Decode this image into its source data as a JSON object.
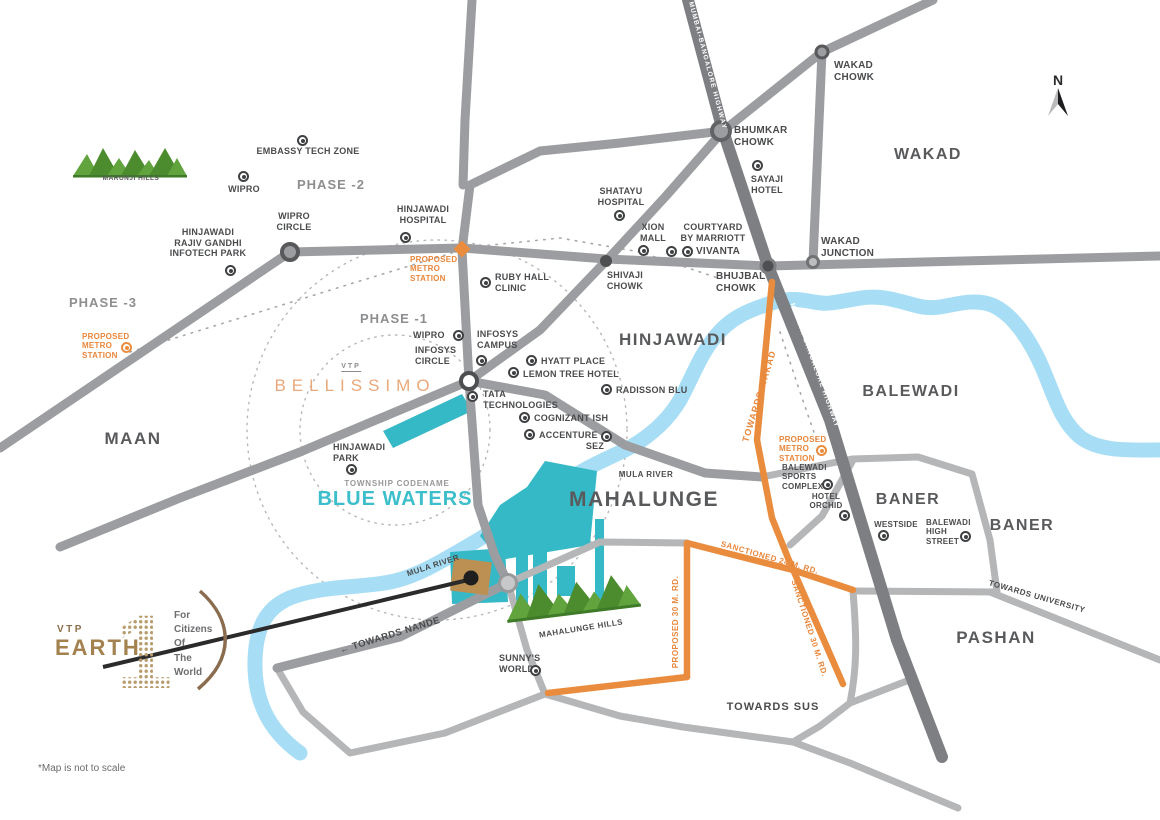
{
  "disclaimer": "*Map is not to scale",
  "compass_label": "N",
  "logo": {
    "brand": "VTP",
    "name": "EARTH",
    "tagline": [
      "For",
      "Citizens",
      "Of",
      "The",
      "World"
    ]
  },
  "bellissimo": {
    "brand": "VTP",
    "name": "BELLISSIMO"
  },
  "township": {
    "label": "TOWNSHIP CODENAME",
    "name": "BLUE WATERS"
  },
  "regions": {
    "wakad": "WAKAD",
    "hinjawadi": "HINJAWADI",
    "balewadi": "BALEWADI",
    "baner1": "BANER",
    "baner2": "BANER",
    "pashan": "PASHAN",
    "maan": "MAAN",
    "mahalunge": "MAHALUNGE"
  },
  "phases": {
    "p1": "PHASE -1",
    "p2": "PHASE -2",
    "p3": "PHASE -3"
  },
  "hills": {
    "marunji": "MARUNJI HILLS",
    "mahalunge": "MAHALUNGE HILLS"
  },
  "rivers": {
    "mula1": "MULA RIVER",
    "mula2": "MULA RIVER"
  },
  "road_labels": {
    "highway1": "MUMBAI-BANGALORE HIGHWAY",
    "highway2": "MUMBAI-BANGALORE HIGHWAY",
    "chandani": "TOWARDS CHANDANI CHOWK",
    "towards_wakad": "TOWARDS WAKAD",
    "sanctioned24": "SANCTIONED 24 M. RD.",
    "sanctioned30": "SANCTIONED 30 M. RD.",
    "proposed30": "PROPOSED 30 M. RD.",
    "towards_sus": "TOWARDS SUS",
    "towards_nande": "← TOWARDS NANDE",
    "towards_university": "TOWARDS UNIVERSITY"
  },
  "pois": [
    {
      "id": "embassy-tech-zone",
      "lines": [
        "EMBASSY TECH ZONE"
      ]
    },
    {
      "id": "wipro-north",
      "lines": [
        "WIPRO"
      ]
    },
    {
      "id": "wipro-circle",
      "lines": [
        "WIPRO",
        "CIRCLE"
      ]
    },
    {
      "id": "infotech-park",
      "lines": [
        "HINJAWADI",
        "RAJIV GANDHI",
        "INFOTECH PARK"
      ]
    },
    {
      "id": "hinjawadi-hospital",
      "lines": [
        "HINJAWADI",
        "HOSPITAL"
      ]
    },
    {
      "id": "metro-center",
      "lines": [
        "PROPOSED",
        "METRO",
        "STATION"
      ]
    },
    {
      "id": "ruby-hall-clinic",
      "lines": [
        "RUBY HALL",
        "CLINIC"
      ]
    },
    {
      "id": "shatayu-hospital",
      "lines": [
        "SHATAYU",
        "HOSPITAL"
      ]
    },
    {
      "id": "shivaji-chowk",
      "lines": [
        "SHIVAJI",
        "CHOWK"
      ]
    },
    {
      "id": "xion-mall",
      "lines": [
        "XION",
        "MALL"
      ]
    },
    {
      "id": "courtyard-by-marriott",
      "lines": [
        "COURTYARD",
        "BY MARRIOTT"
      ]
    },
    {
      "id": "vivanta",
      "lines": [
        "VIVANTA"
      ]
    },
    {
      "id": "sayaji-hotel",
      "lines": [
        "SAYAJI",
        "HOTEL"
      ]
    },
    {
      "id": "bhumkar-chowk",
      "lines": [
        "BHUMKAR",
        "CHOWK"
      ]
    },
    {
      "id": "wakad-chowk",
      "lines": [
        "WAKAD",
        "CHOWK"
      ]
    },
    {
      "id": "wakad-junction",
      "lines": [
        "WAKAD",
        "JUNCTION"
      ]
    },
    {
      "id": "bhujbal-chowk",
      "lines": [
        "BHUJBAL",
        "CHOWK"
      ]
    },
    {
      "id": "wipro-phase1",
      "lines": [
        "WIPRO"
      ]
    },
    {
      "id": "infosys-campus",
      "lines": [
        "INFOSYS",
        "CAMPUS"
      ]
    },
    {
      "id": "infosys-circle",
      "lines": [
        "INFOSYS",
        "CIRCLE"
      ]
    },
    {
      "id": "hyatt-place",
      "lines": [
        "HYATT PLACE"
      ]
    },
    {
      "id": "lemon-tree-hotel",
      "lines": [
        "LEMON TREE HOTEL"
      ]
    },
    {
      "id": "radisson-blu",
      "lines": [
        "RADISSON BLU"
      ]
    },
    {
      "id": "tata-technologies",
      "lines": [
        "TATA",
        "TECHNOLOGIES"
      ]
    },
    {
      "id": "cognizant-ish",
      "lines": [
        "COGNIZANT ISH"
      ]
    },
    {
      "id": "accenture",
      "lines": [
        "ACCENTURE"
      ]
    },
    {
      "id": "sez",
      "lines": [
        "SEZ"
      ]
    },
    {
      "id": "hinjawadi-park",
      "lines": [
        "HINJAWADI",
        "PARK"
      ]
    },
    {
      "id": "sunnys-world",
      "lines": [
        "SUNNY'S",
        "WORLD"
      ]
    },
    {
      "id": "balewadi-sports-complex",
      "lines": [
        "BALEWADI",
        "SPORTS",
        "COMPLEX"
      ]
    },
    {
      "id": "hotel-orchid",
      "lines": [
        "HOTEL",
        "ORCHID"
      ]
    },
    {
      "id": "metro-balewadi",
      "lines": [
        "PROPOSED",
        "METRO",
        "STATION"
      ]
    },
    {
      "id": "westside",
      "lines": [
        "WESTSIDE"
      ]
    },
    {
      "id": "balewadi-high-street",
      "lines": [
        "BALEWADI",
        "HIGH",
        "STREET"
      ]
    },
    {
      "id": "metro-west",
      "lines": [
        "PROPOSED",
        "METRO",
        "STATION"
      ]
    }
  ],
  "colors": {
    "accent_orange": "#e98c3e",
    "project_teal": "#36b9c6",
    "township_teal": "#3cbecb",
    "river_blue": "#a8def5",
    "road_gray": "#9c9da0",
    "road_dark": "#7e7f82",
    "road_light": "#b5b6b8",
    "hills_green": "#5fa23c",
    "logo_gold": "#a3824f",
    "bellissimo_salmon": "#e9a87b"
  }
}
